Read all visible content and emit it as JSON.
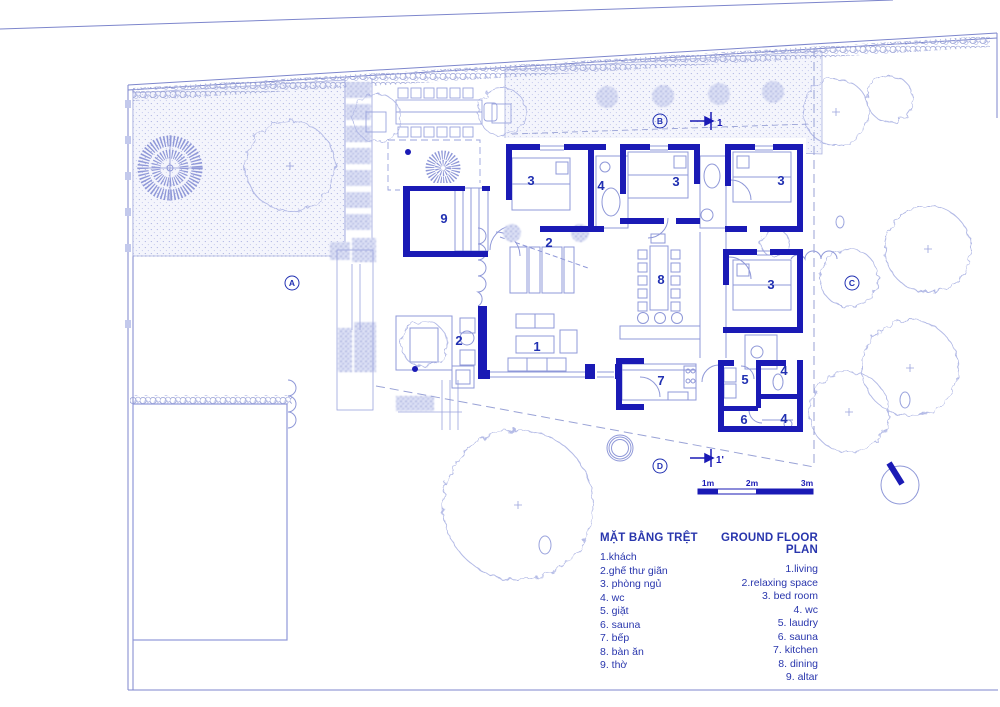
{
  "drawing": {
    "rooms": [
      {
        "id": "altar",
        "num": "9"
      },
      {
        "id": "bedroom-top-1",
        "num": "3"
      },
      {
        "id": "wc-top",
        "num": "4"
      },
      {
        "id": "relax-inner",
        "num": "2"
      },
      {
        "id": "bedroom-top-2",
        "num": "3"
      },
      {
        "id": "bedroom-top-3",
        "num": "3"
      },
      {
        "id": "dining",
        "num": "8"
      },
      {
        "id": "bedroom-right",
        "num": "3"
      },
      {
        "id": "relax-terrace",
        "num": "2"
      },
      {
        "id": "living",
        "num": "1"
      },
      {
        "id": "kitchen",
        "num": "7"
      },
      {
        "id": "laundry",
        "num": "5"
      },
      {
        "id": "wc-mid",
        "num": "4"
      },
      {
        "id": "sauna",
        "num": "6"
      },
      {
        "id": "wc-bottom",
        "num": "4"
      }
    ],
    "section_letters": [
      "A",
      "B",
      "C",
      "D"
    ],
    "cut_markers": [
      "1",
      "1'"
    ],
    "scale_labels": [
      "1m",
      "2m",
      "3m"
    ]
  },
  "legend": {
    "vi": {
      "title": "MẶT BẰNG TRỆT",
      "items": [
        "1.khách",
        "2.ghế thư giãn",
        "3. phòng ngủ",
        "4. wc",
        "5. giặt",
        "6. sauna",
        "7. bếp",
        "8. bàn ăn",
        "9. thờ"
      ]
    },
    "en": {
      "title": "GROUND FLOOR PLAN",
      "items": [
        "1.living",
        "2.relaxing space",
        "3. bed room",
        "4. wc",
        "5. laudry",
        "6. sauna",
        "7. kitchen",
        "8. dining",
        "9. altar"
      ]
    }
  },
  "colors": {
    "wall": "#1a1ab5",
    "text": "#2936ad",
    "thin_line": "#8f98d8"
  }
}
